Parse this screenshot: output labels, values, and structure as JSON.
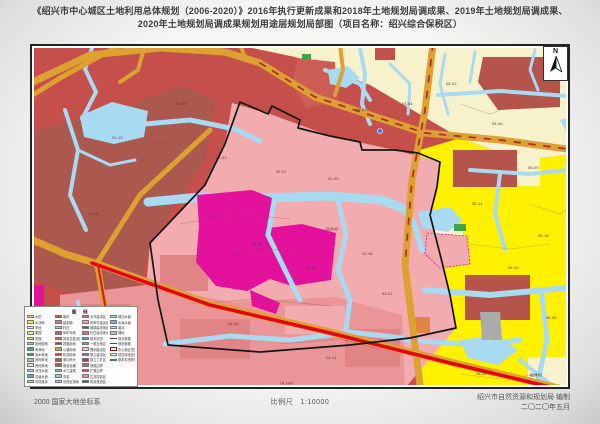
{
  "title": {
    "line1": "《绍兴市中心城区土地利用总体规划（2006-2020）》2016年执行更新成果和2018年土地规划局调成果、2019年土地规划局调成果、",
    "line2": "2020年土地规划局调成果规划用途层规划局部图（项目名称：绍兴综合保税区）"
  },
  "map": {
    "north_label": "N",
    "colors": {
      "urban_red": "#C5504B",
      "dark_red": "#AB584F",
      "village_pink": "#F2ABAE",
      "salmon": "#EA9598",
      "magenta": "#E3119C",
      "water_blue": "#A8DAF2",
      "road_orange": "#DFA032",
      "highway_red": "#E60012",
      "farm_yellow": "#FFF100",
      "pale_cream": "#F8F2CC"
    },
    "labels": [
      {
        "x": 296,
        "y": 182,
        "t": "凤台村"
      },
      {
        "x": 500,
        "y": 328,
        "t": "梅林村"
      },
      {
        "x": 248,
        "y": 336,
        "t": "（A.GB）"
      },
      {
        "x": 146,
        "y": 58,
        "t": "01-05"
      },
      {
        "x": 82,
        "y": 92,
        "t": "01-12"
      },
      {
        "x": 58,
        "y": 168,
        "t": "01-18"
      },
      {
        "x": 186,
        "y": 112,
        "t": "02-03"
      },
      {
        "x": 246,
        "y": 126,
        "t": "02-07"
      },
      {
        "x": 298,
        "y": 133,
        "t": "02-05"
      },
      {
        "x": 222,
        "y": 198,
        "t": "02-12"
      },
      {
        "x": 276,
        "y": 222,
        "t": "02-15"
      },
      {
        "x": 332,
        "y": 208,
        "t": "02-18"
      },
      {
        "x": 352,
        "y": 248,
        "t": "02-21"
      },
      {
        "x": 198,
        "y": 278,
        "t": "04-06"
      },
      {
        "x": 296,
        "y": 312,
        "t": "04-11"
      },
      {
        "x": 416,
        "y": 38,
        "t": "05-02"
      },
      {
        "x": 462,
        "y": 78,
        "t": "05-06"
      },
      {
        "x": 498,
        "y": 122,
        "t": "05-09"
      },
      {
        "x": 442,
        "y": 158,
        "t": "05-14"
      },
      {
        "x": 478,
        "y": 222,
        "t": "06-03"
      },
      {
        "x": 516,
        "y": 272,
        "t": "06-08"
      },
      {
        "x": 446,
        "y": 328,
        "t": "06-12"
      },
      {
        "x": 372,
        "y": 58,
        "t": "03-04"
      },
      {
        "x": 326,
        "y": 64,
        "t": "03-07"
      },
      {
        "x": 508,
        "y": 190,
        "t": "05-18"
      }
    ]
  },
  "legend": {
    "title": "图 例",
    "columns": [
      [
        {
          "k": "fill",
          "c": "#F7D06B",
          "t": "水田"
        },
        {
          "k": "fill",
          "c": "#FFE94A",
          "t": "水浇地"
        },
        {
          "k": "fill",
          "c": "#F2EFB4",
          "t": "旱地"
        },
        {
          "k": "fill",
          "c": "#D7ED9C",
          "t": "果园"
        },
        {
          "k": "fill",
          "c": "#BCE77D",
          "t": "茶园"
        },
        {
          "k": "fill",
          "c": "#9ED06B",
          "t": "其他园地"
        },
        {
          "k": "fill",
          "c": "#4FB04F",
          "t": "有林地"
        },
        {
          "k": "fill",
          "c": "#3C9A46",
          "t": "灌木林地"
        },
        {
          "k": "fill",
          "c": "#A7CB7B",
          "t": "其他林地"
        },
        {
          "k": "fill",
          "c": "#EDE3A9",
          "t": "其他草地"
        },
        {
          "k": "fill",
          "c": "#A5D9F2",
          "t": "河流水面"
        },
        {
          "k": "fill",
          "c": "#57A3DB",
          "t": "坑塘水面"
        },
        {
          "k": "fill",
          "c": "#9FD4F0",
          "t": "内陆滩涂"
        }
      ],
      [
        {
          "k": "fill",
          "c": "#C5504B",
          "t": "城市"
        },
        {
          "k": "fill",
          "c": "#D9736C",
          "t": "建制镇"
        },
        {
          "k": "fill",
          "c": "#F2ABAE",
          "t": "村庄"
        },
        {
          "k": "fill",
          "c": "#B2675B",
          "t": "采矿用地"
        },
        {
          "k": "fill",
          "c": "#CE6B62",
          "t": "风景名胜设施"
        },
        {
          "k": "fill",
          "c": "#9E4B44",
          "t": "铁路用地"
        },
        {
          "k": "fill",
          "c": "#DFA032",
          "t": "公路用地"
        },
        {
          "k": "fill",
          "c": "#C04E48",
          "t": "机场用地"
        },
        {
          "k": "fill",
          "c": "#B5544B",
          "t": "港口码头"
        },
        {
          "k": "fill",
          "c": "#D14A43",
          "t": "管道运输"
        },
        {
          "k": "fill",
          "c": "#7FB6DC",
          "t": "水工建筑"
        },
        {
          "k": "fill",
          "c": "#8FC6E8",
          "t": "沟渠"
        },
        {
          "k": "fill",
          "c": "#E2C06A",
          "t": "设施农用地"
        }
      ],
      [
        {
          "k": "fill",
          "c": "#E06A6A",
          "t": "允许建设区"
        },
        {
          "k": "fill",
          "c": "#F0A0C8",
          "t": "有条件建设区"
        },
        {
          "k": "fill",
          "c": "#E20C8C",
          "t": "城镇建设用地"
        },
        {
          "k": "fill",
          "c": "#D86AA0",
          "t": "村庄建设用地"
        },
        {
          "k": "fill",
          "c": "#4FA3D8",
          "t": "基本农田"
        },
        {
          "k": "fill",
          "c": "#3BB6B0",
          "t": "一般农地区"
        },
        {
          "k": "fill",
          "c": "#F2C3D8",
          "t": "限制建设区"
        },
        {
          "k": "fill",
          "c": "#8E6AB8",
          "t": "禁止建设区"
        },
        {
          "k": "fill",
          "c": "#A03A78",
          "t": "独立工矿区"
        },
        {
          "k": "fill",
          "c": "#B05AA0",
          "t": "规模边界"
        },
        {
          "k": "fill",
          "c": "#C94A8C",
          "t": "扩展边界"
        },
        {
          "k": "fill",
          "c": "#E88FB0",
          "t": "生态控制区"
        },
        {
          "k": "fill",
          "c": "#B5322E",
          "t": "风景旅游区"
        }
      ],
      [
        {
          "k": "fill",
          "c": "#A8DAF2",
          "t": "湖泊水面"
        },
        {
          "k": "fill",
          "c": "#6FB1E0",
          "t": "水库水面"
        },
        {
          "k": "fill",
          "c": "#BFE0F0",
          "t": "滩涂"
        },
        {
          "k": "fill",
          "c": "#BFBFBF",
          "t": "裸地"
        },
        {
          "k": "line",
          "c": "#444444",
          "t": "现状铁路"
        },
        {
          "k": "line",
          "c": "#E3000F",
          "t": "规划道路"
        },
        {
          "k": "outline",
          "c": "#8B1A12",
          "t": "中心城区范围"
        },
        {
          "k": "outline",
          "c": "#6B8E23",
          "t": "项目用地范围"
        },
        {
          "k": "line",
          "c": "#2E8B2E",
          "t": "基本农田界线"
        }
      ]
    ]
  },
  "footer": {
    "datum": "2000 国家大地坐标系",
    "scale_label": "比例尺",
    "scale_value": "1:10000",
    "credit": "绍兴市自然资源和规划局  编制",
    "date": "二〇二〇年五月"
  }
}
